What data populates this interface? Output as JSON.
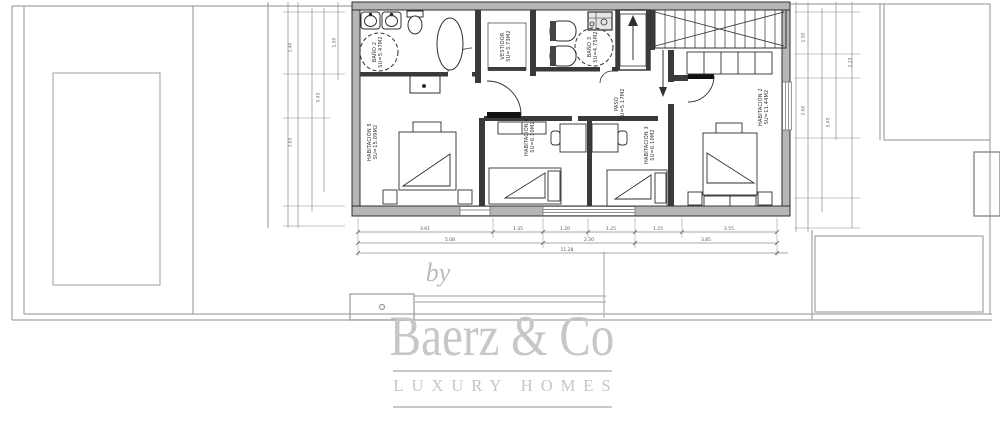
{
  "watermark": {
    "by": "by",
    "brand": "Baerz & Co",
    "tagline": "LUXURY HOMES"
  },
  "rooms": [
    {
      "name": "BAÑO 2",
      "area": "SU=5.47M2"
    },
    {
      "name": "VESTIDOR",
      "area": "SU=3.73M2"
    },
    {
      "name": "BAÑO 3",
      "area": "SU=4.75M2"
    },
    {
      "name": "PASO",
      "area": "SU=5.17M2"
    },
    {
      "name": "HABITACIÓN 5",
      "area": "SU=15.09M2"
    },
    {
      "name": "HABITACIÓN 4",
      "area": "SU=6.10M2"
    },
    {
      "name": "HABITACIÓN 3",
      "area": "SU=6.10M2"
    },
    {
      "name": "HABITACIÓN 2",
      "area": "SU=11.44M2"
    }
  ],
  "dimensions": {
    "bottom_row1": [
      "3.61",
      "1.35",
      "1.20",
      "1.25",
      "1.25",
      "2.55"
    ],
    "bottom_row2": [
      "5.08",
      "2.30",
      "3.85"
    ],
    "bottom_total": "11.28",
    "left_col": [
      "1.40",
      "3.65",
      "5.45",
      "1.50"
    ],
    "right_col": [
      "1.50",
      "2.60",
      "5.45",
      "2.15"
    ]
  },
  "colors": {
    "wall_fill": "#b6b6b6",
    "line_dark": "#2e2e2e",
    "line_site": "#a3a3a3",
    "watermark": "#c7c7c7"
  }
}
